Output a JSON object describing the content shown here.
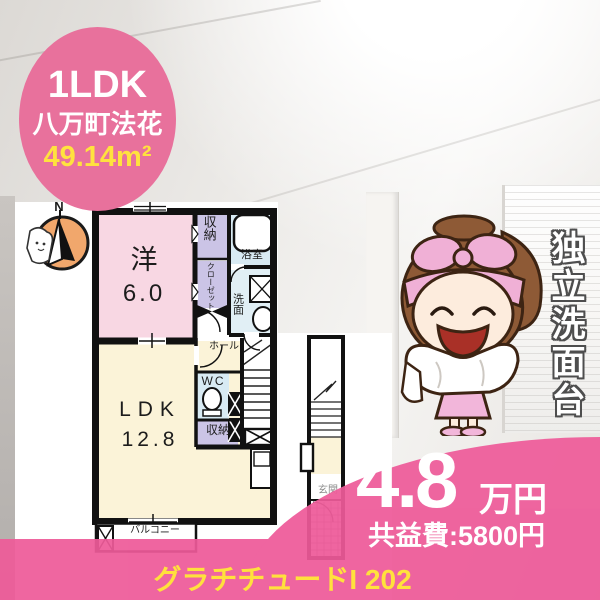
{
  "badge": {
    "layout": "1LDK",
    "location": "八万町法花",
    "area": "49.14m²"
  },
  "floor_plan": {
    "compass": "N",
    "rooms": {
      "western": {
        "label": "洋",
        "size": "6.0"
      },
      "ldk": {
        "label": "LDK",
        "size": "12.8"
      },
      "storage_top": "収納",
      "closet": "クローゼット",
      "bath": "浴室",
      "washroom": "洗面",
      "hall": "ホール",
      "wc": "WC",
      "storage_mid": "収納",
      "balcony": "バルコニー",
      "entrance": "玄関"
    }
  },
  "feature": {
    "vertical_text": "独立洗面台"
  },
  "price": {
    "rent": "4.8",
    "unit": "万円",
    "common_fee": "共益費:5800円"
  },
  "footer": {
    "title": "グラチチュードI 202"
  },
  "colors": {
    "accent_pink": "#ee5a99",
    "badge_pink": "#e8719c",
    "highlight_yellow": "#ffe23e"
  }
}
